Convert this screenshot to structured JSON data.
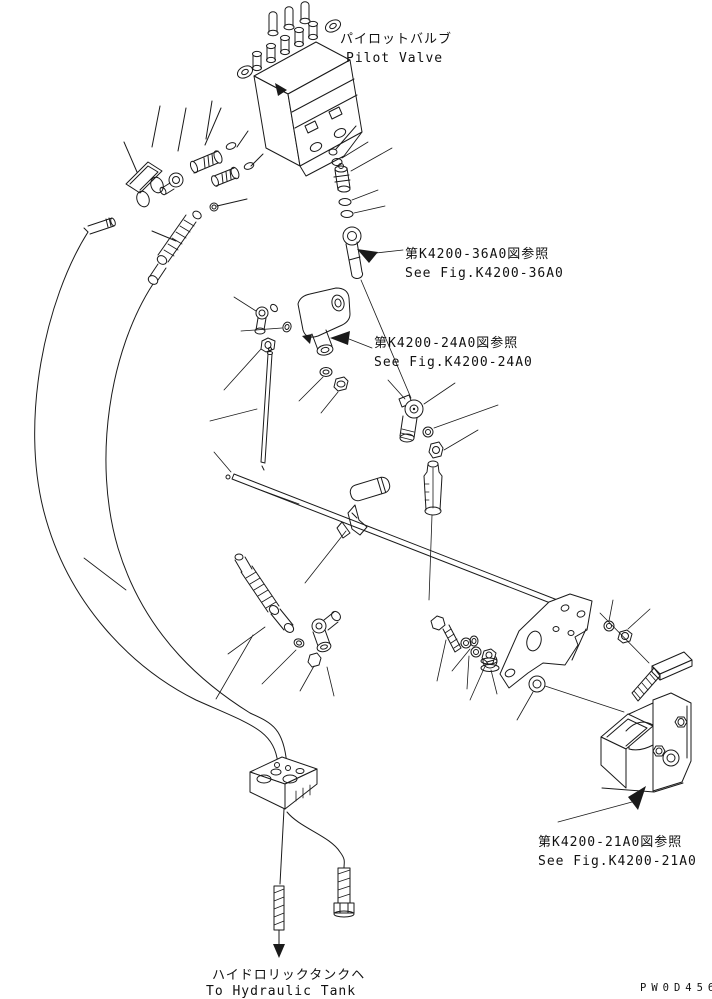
{
  "page": {
    "bg": "#ffffff",
    "ink": "#1a1a1a",
    "doc_code": "PW0D456"
  },
  "labels": {
    "pilot_jp": "パイロットバルブ",
    "pilot_en": "Pilot Valve",
    "fig36_jp": "第K4200-36A0図参照",
    "fig36_en": "See Fig.K4200-36A0",
    "fig24_jp": "第K4200-24A0図参照",
    "fig24_en": "See Fig.K4200-24A0",
    "fig21_jp": "第K4200-21A0図参照",
    "fig21_en": "See Fig.K4200-21A0",
    "tank_jp": "ハイドロリックタンクヘ",
    "tank_en": "To Hydraulic Tank"
  }
}
